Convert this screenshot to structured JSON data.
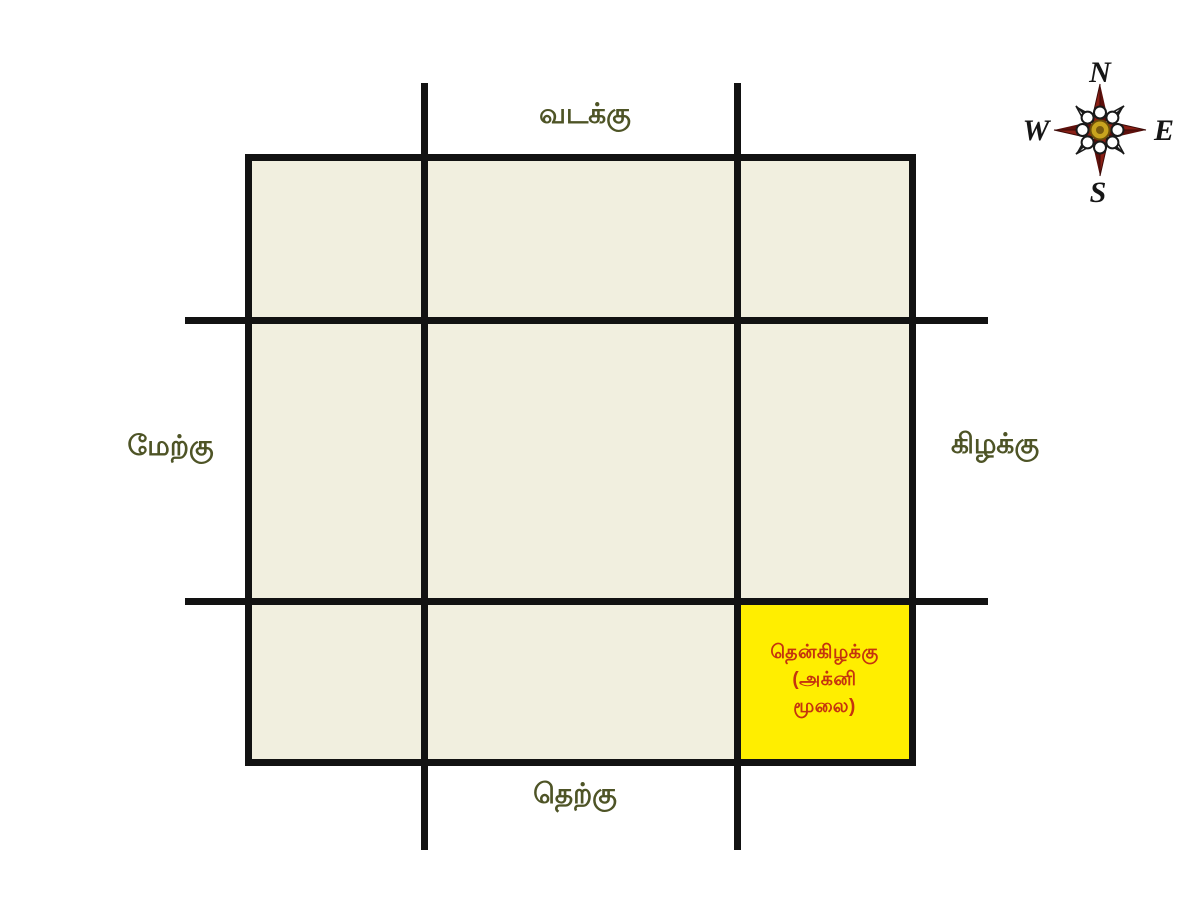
{
  "diagram": {
    "kind": "direction-grid",
    "labels": {
      "north": "வடக்கு",
      "south": "தெற்கு",
      "west": "மேற்கு",
      "east": "கிழக்கு",
      "text_color": "#4e5426"
    },
    "southeast_cell": {
      "line1": "தென்கிழக்கு",
      "line2": "(அக்னி",
      "line3": "மூலை)",
      "fill": "#ffee00",
      "text_color": "#c5340e"
    },
    "grid": {
      "cell_fill": "#f1efdf",
      "line_color": "#121212"
    },
    "compass": {
      "north": "N",
      "east": "E",
      "south": "S",
      "west": "W",
      "cardinal_color": "#5e100c",
      "cardinal_color_light": "#8b2016",
      "diagonal_color": "#1a1a1a",
      "center_color": "#c8a41e"
    }
  }
}
